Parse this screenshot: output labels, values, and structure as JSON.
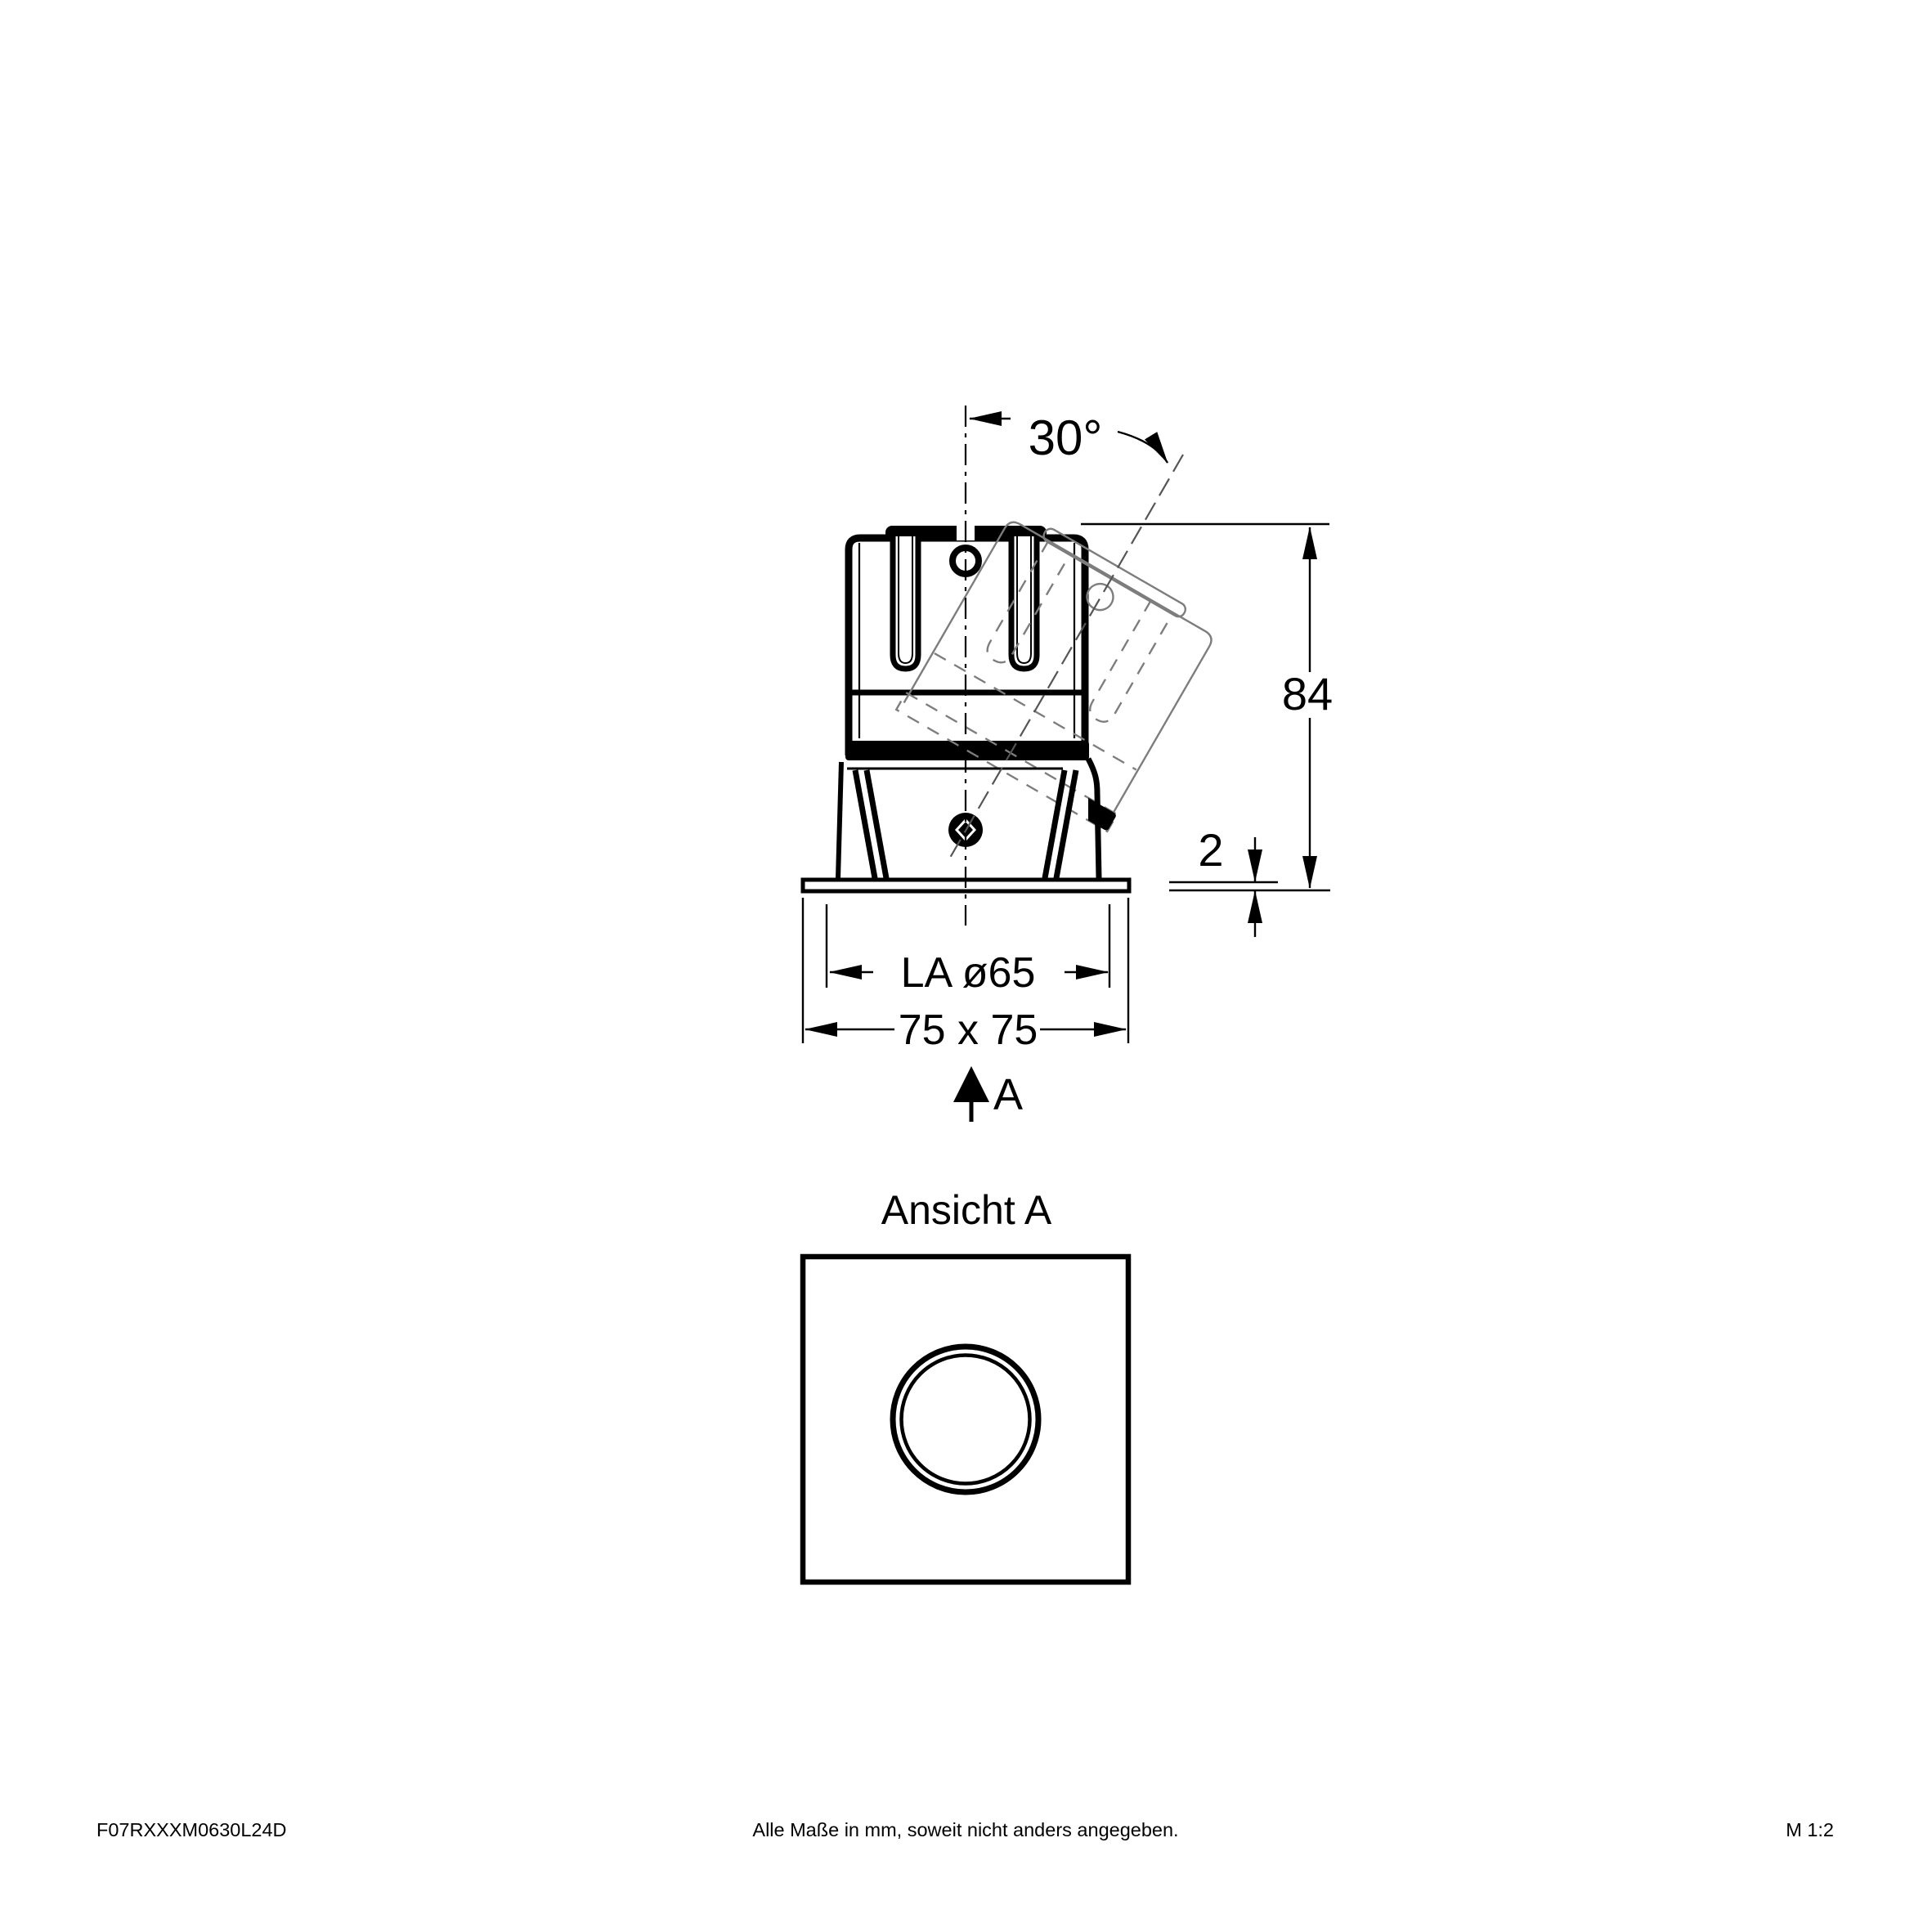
{
  "document": {
    "background": "#ffffff",
    "line_color": "#000000",
    "ghost_color": "#7d7d7d"
  },
  "side_view": {
    "tilt_angle_label": "30°",
    "height_label": "84",
    "trim_thickness_label": "2",
    "cutout_label": "LA ø65",
    "overall_size_label": "75 x 75",
    "view_marker_label": "A"
  },
  "front_view": {
    "title": "Ansicht A"
  },
  "footer": {
    "article_code": "F07RXXXM0630L24D",
    "note": "Alle Maße in mm, soweit nicht anders angegeben.",
    "scale": "M 1:2"
  }
}
